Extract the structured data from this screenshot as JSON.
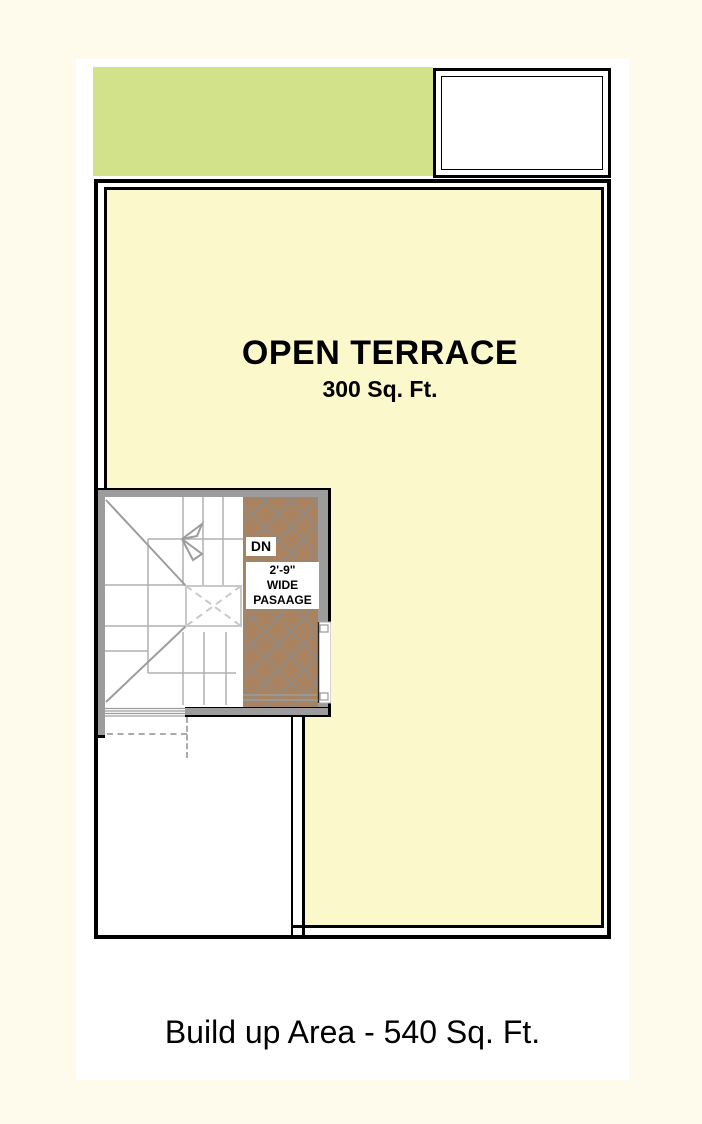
{
  "plan": {
    "terrace": {
      "title": "OPEN TERRACE",
      "area": "300 Sq. Ft."
    },
    "stair": {
      "direction_label": "DN",
      "passage": {
        "line1": "2'-9\"",
        "line2": "WIDE",
        "line3": "PASAAGE"
      }
    },
    "footer": {
      "text": "Build up Area - 540 Sq. Ft."
    }
  },
  "colors": {
    "background": "#FFFBEC",
    "sheet": "#FFFFFF",
    "green_block": "#D1E28B",
    "terrace_fill": "#FBF8CC",
    "passage_brown": "#A9835F",
    "wall_gray": "#9C9C9C",
    "stair_line_gray": "#B0B0B0",
    "hatch_line": "#8A8A8A",
    "outline_black": "#000000"
  }
}
